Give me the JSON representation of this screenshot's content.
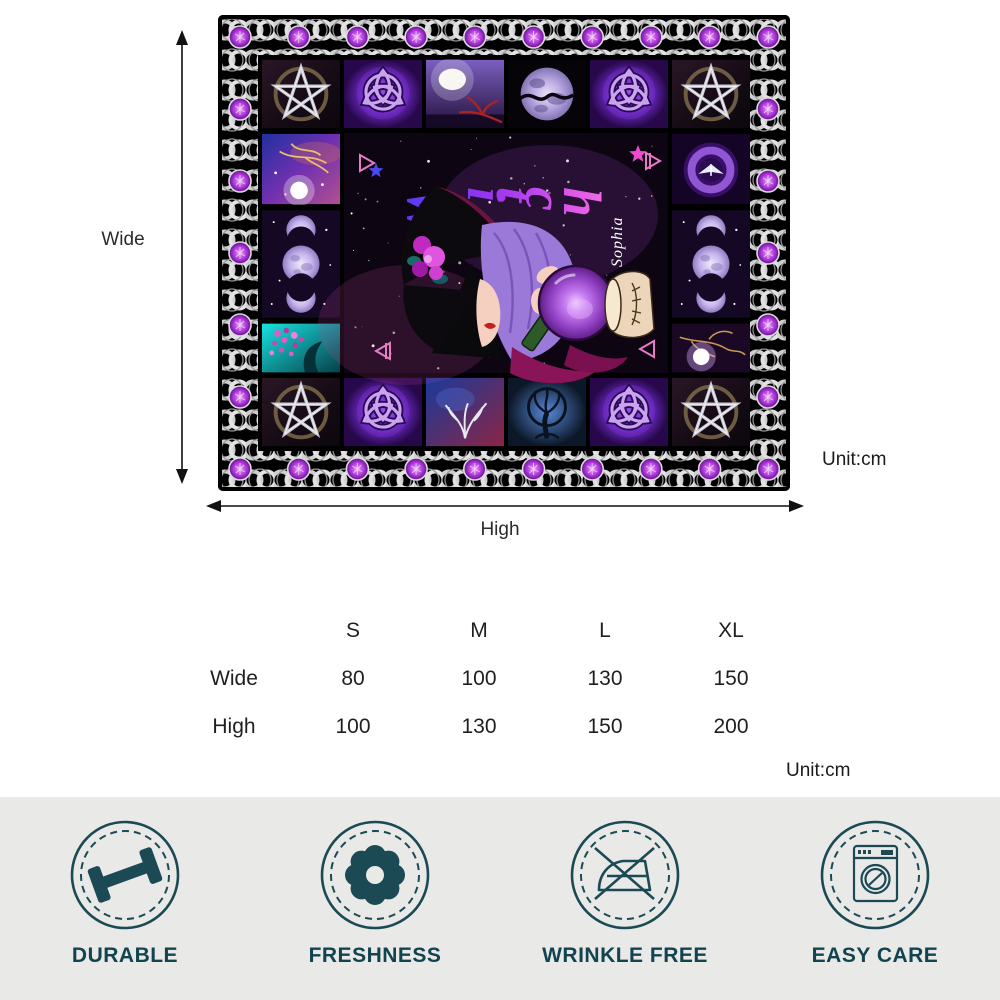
{
  "blanket": {
    "wordmark_text": "Witch",
    "personal_name": "Sophia",
    "motifs": [
      "pentagram",
      "triquetra",
      "moon-landscape",
      "full-moon",
      "triple-moon",
      "galaxy-tree",
      "teal-blossom-tree",
      "moth-nebula",
      "glowing-tree",
      "nebula-tree",
      "tree-of-life",
      "witch-with-crystal-ball",
      "celtic-knot-border",
      "purple-gems"
    ],
    "colors": {
      "border_black": "#000000",
      "knot_silver": "#d2d2d2",
      "gem_purple": "#b13fd6",
      "glow_purple": "#9747c9",
      "space_dark": "#0d0612",
      "wordmark_gradient_start": "#3d3df5",
      "wordmark_gradient_end": "#ff8ae0"
    }
  },
  "size_guide": {
    "wide_label": "Wide",
    "high_label": "High",
    "unit_label_top": "Unit:cm",
    "unit_label_table": "Unit:cm",
    "table": {
      "columns": [
        "S",
        "M",
        "L",
        "XL"
      ],
      "rows": [
        {
          "label": "Wide",
          "values": [
            80,
            100,
            130,
            150
          ]
        },
        {
          "label": "High",
          "values": [
            100,
            130,
            150,
            200
          ]
        }
      ]
    }
  },
  "features": [
    {
      "label": "DURABLE",
      "icon": "dumbbell-icon"
    },
    {
      "label": "FRESHNESS",
      "icon": "flower-icon"
    },
    {
      "label": "WRINKLE FREE",
      "icon": "no-iron-icon"
    },
    {
      "label": "EASY CARE",
      "icon": "washing-machine-icon"
    }
  ],
  "feature_bar_color": "#e9e9e7",
  "feature_text_color": "#12444f"
}
